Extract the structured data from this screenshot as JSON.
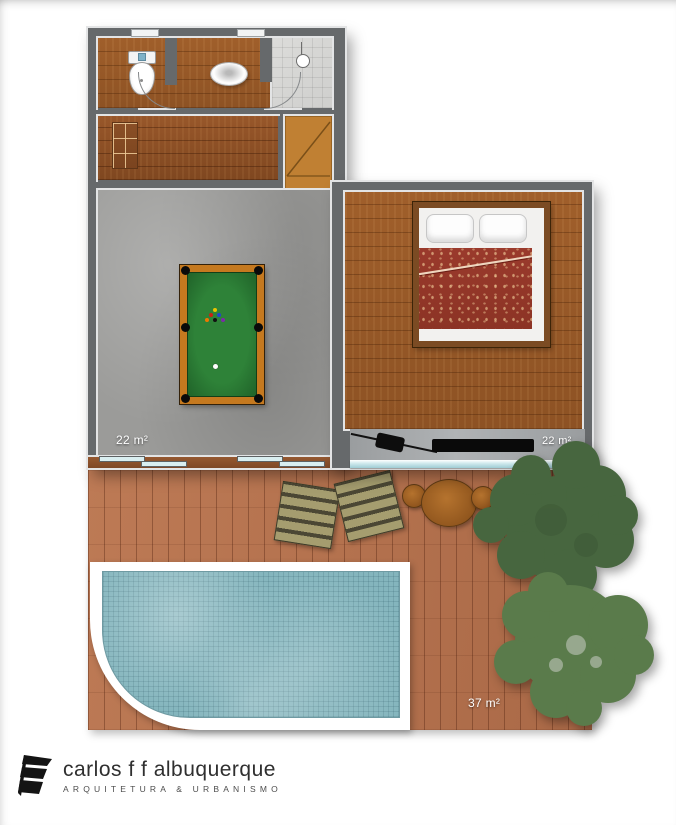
{
  "title": "Upper floor plan with pool deck",
  "rooms": {
    "game_room": {
      "label": "game room",
      "area": "22 m²"
    },
    "bedroom": {
      "label": "bedroom",
      "area": "22 m²"
    },
    "deck": {
      "label": "pool deck",
      "area": "37 m²"
    }
  },
  "fixtures": {
    "toilet": "toilet",
    "washbasin": "washbasin",
    "shower": "shower-stall",
    "closet": "closet-shelves",
    "stairs": "winder-staircase",
    "pool_table": "billiard-table",
    "double_bed": "double-bed",
    "grill": "barbecue-grill",
    "bench": "black-bench",
    "lounger": "deck-lounger",
    "round_table": "round-wood-table",
    "stool": "round-stool",
    "swimming_pool": "swimming-pool",
    "trees": "tree-canopies",
    "sliding_doors": "sliding-glass-doors",
    "glass_railing": "glass-railing"
  },
  "logo": {
    "name": "carlos f f albuquerque",
    "tagline": "ARQUITETURA & URBANISMO"
  },
  "colors": {
    "wall": "#66696b",
    "wall_edge": "#e3e4e5",
    "wood_floor": "#9a5c2a",
    "concrete": "#9b9b99",
    "stairs": "#c08033",
    "deck": "#b5714e",
    "pool_water": "#84b5bd",
    "tree_dark": "#47663f",
    "tree_light": "#5a7b4b",
    "billiard_felt": "#2e8238",
    "billiard_rail": "#c5791f",
    "duvet_red": "#9a3a2c",
    "railing_glass": "#cde8ec"
  }
}
